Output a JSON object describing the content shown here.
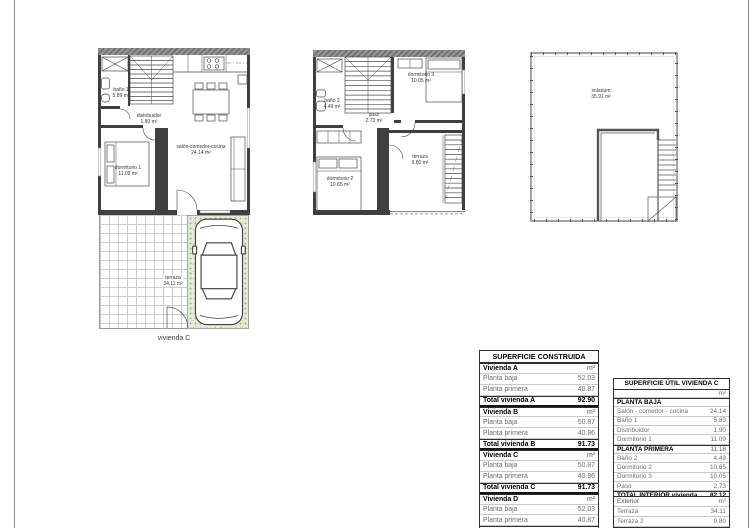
{
  "sheet": {
    "caption": "vivienda C"
  },
  "plans": {
    "planta_baja": {
      "rooms": {
        "bano1": {
          "name": "baño 1",
          "area": "5.89 m²"
        },
        "distribuidor": {
          "name": "distribuidor",
          "area": "1.90 m²"
        },
        "salon": {
          "name": "salón-comedor-cocina",
          "area": "24.14 m²"
        },
        "dormitorio1": {
          "name": "dormitorio 1",
          "area": "11.09 m²"
        },
        "terraza": {
          "name": "terraza",
          "area": "34.11 m²"
        }
      }
    },
    "planta_primera": {
      "rooms": {
        "bano2": {
          "name": "baño 2",
          "area": "4.49 m²"
        },
        "paso": {
          "name": "paso",
          "area": "2.73 m²"
        },
        "dormitorio3": {
          "name": "dormitorio 3",
          "area": "10.05 m²"
        },
        "dormitorio2": {
          "name": "dormitorio 2",
          "area": "10.65 m²"
        },
        "terraza": {
          "name": "terraza",
          "area": "9.80 m²"
        }
      }
    },
    "solarium": {
      "rooms": {
        "solarium": {
          "name": "solarium",
          "area": "35.91 m²"
        }
      }
    }
  },
  "tables": {
    "construida": {
      "title": "SUPERFICIE CONSTRUIDA",
      "rows": [
        {
          "label": "Vivienda A",
          "value": "m²"
        },
        {
          "label": "Planta baja",
          "value": "52.03"
        },
        {
          "label": "Planta primera",
          "value": "40.87"
        },
        {
          "label": "Total vivienda A",
          "value": "92.90"
        },
        {
          "label": "Vivienda B",
          "value": "m²"
        },
        {
          "label": "Planta baja",
          "value": "50.87"
        },
        {
          "label": "Planta primera",
          "value": "40.86"
        },
        {
          "label": "Total vivienda B",
          "value": "91.73"
        },
        {
          "label": "Vivienda C",
          "value": "m²"
        },
        {
          "label": "Planta baja",
          "value": "50.87"
        },
        {
          "label": "Planta primera",
          "value": "40.86"
        },
        {
          "label": "Total vivienda C",
          "value": "91.73"
        },
        {
          "label": "Vivienda D",
          "value": "m²"
        },
        {
          "label": "Planta baja",
          "value": "52.03"
        },
        {
          "label": "Planta primera",
          "value": "40.87"
        },
        {
          "label": "Total vivienda D",
          "value": "92.90"
        }
      ]
    },
    "util": {
      "title": "SUPERFICIE ÚTIL VIVIENDA C",
      "rows": [
        {
          "label": "",
          "value": "m²"
        },
        {
          "label": "PLANTA BAJA",
          "value": ""
        },
        {
          "label": "Salón - comedor - cocina",
          "value": "24.14"
        },
        {
          "label": "Baño 1",
          "value": "5.89"
        },
        {
          "label": "Distribuidor",
          "value": "1.90"
        },
        {
          "label": "Dormitorio 1",
          "value": "11.09"
        },
        {
          "label": "PLANTA PRIMERA",
          "value": "11.18"
        },
        {
          "label": "Baño 2",
          "value": "4.49"
        },
        {
          "label": "Dormitorio 2",
          "value": "10.65"
        },
        {
          "label": "Dormitorio 3",
          "value": "10.05"
        },
        {
          "label": "Paso",
          "value": "2.73"
        },
        {
          "label": "TOTAL INTERIOR vivienda",
          "value": "82.12"
        }
      ],
      "exterior": {
        "rows": [
          {
            "label": "Exterior",
            "value": "m²"
          },
          {
            "label": "Terraza",
            "value": "34.11"
          },
          {
            "label": "Terraza 2",
            "value": "9.80"
          }
        ]
      }
    }
  }
}
